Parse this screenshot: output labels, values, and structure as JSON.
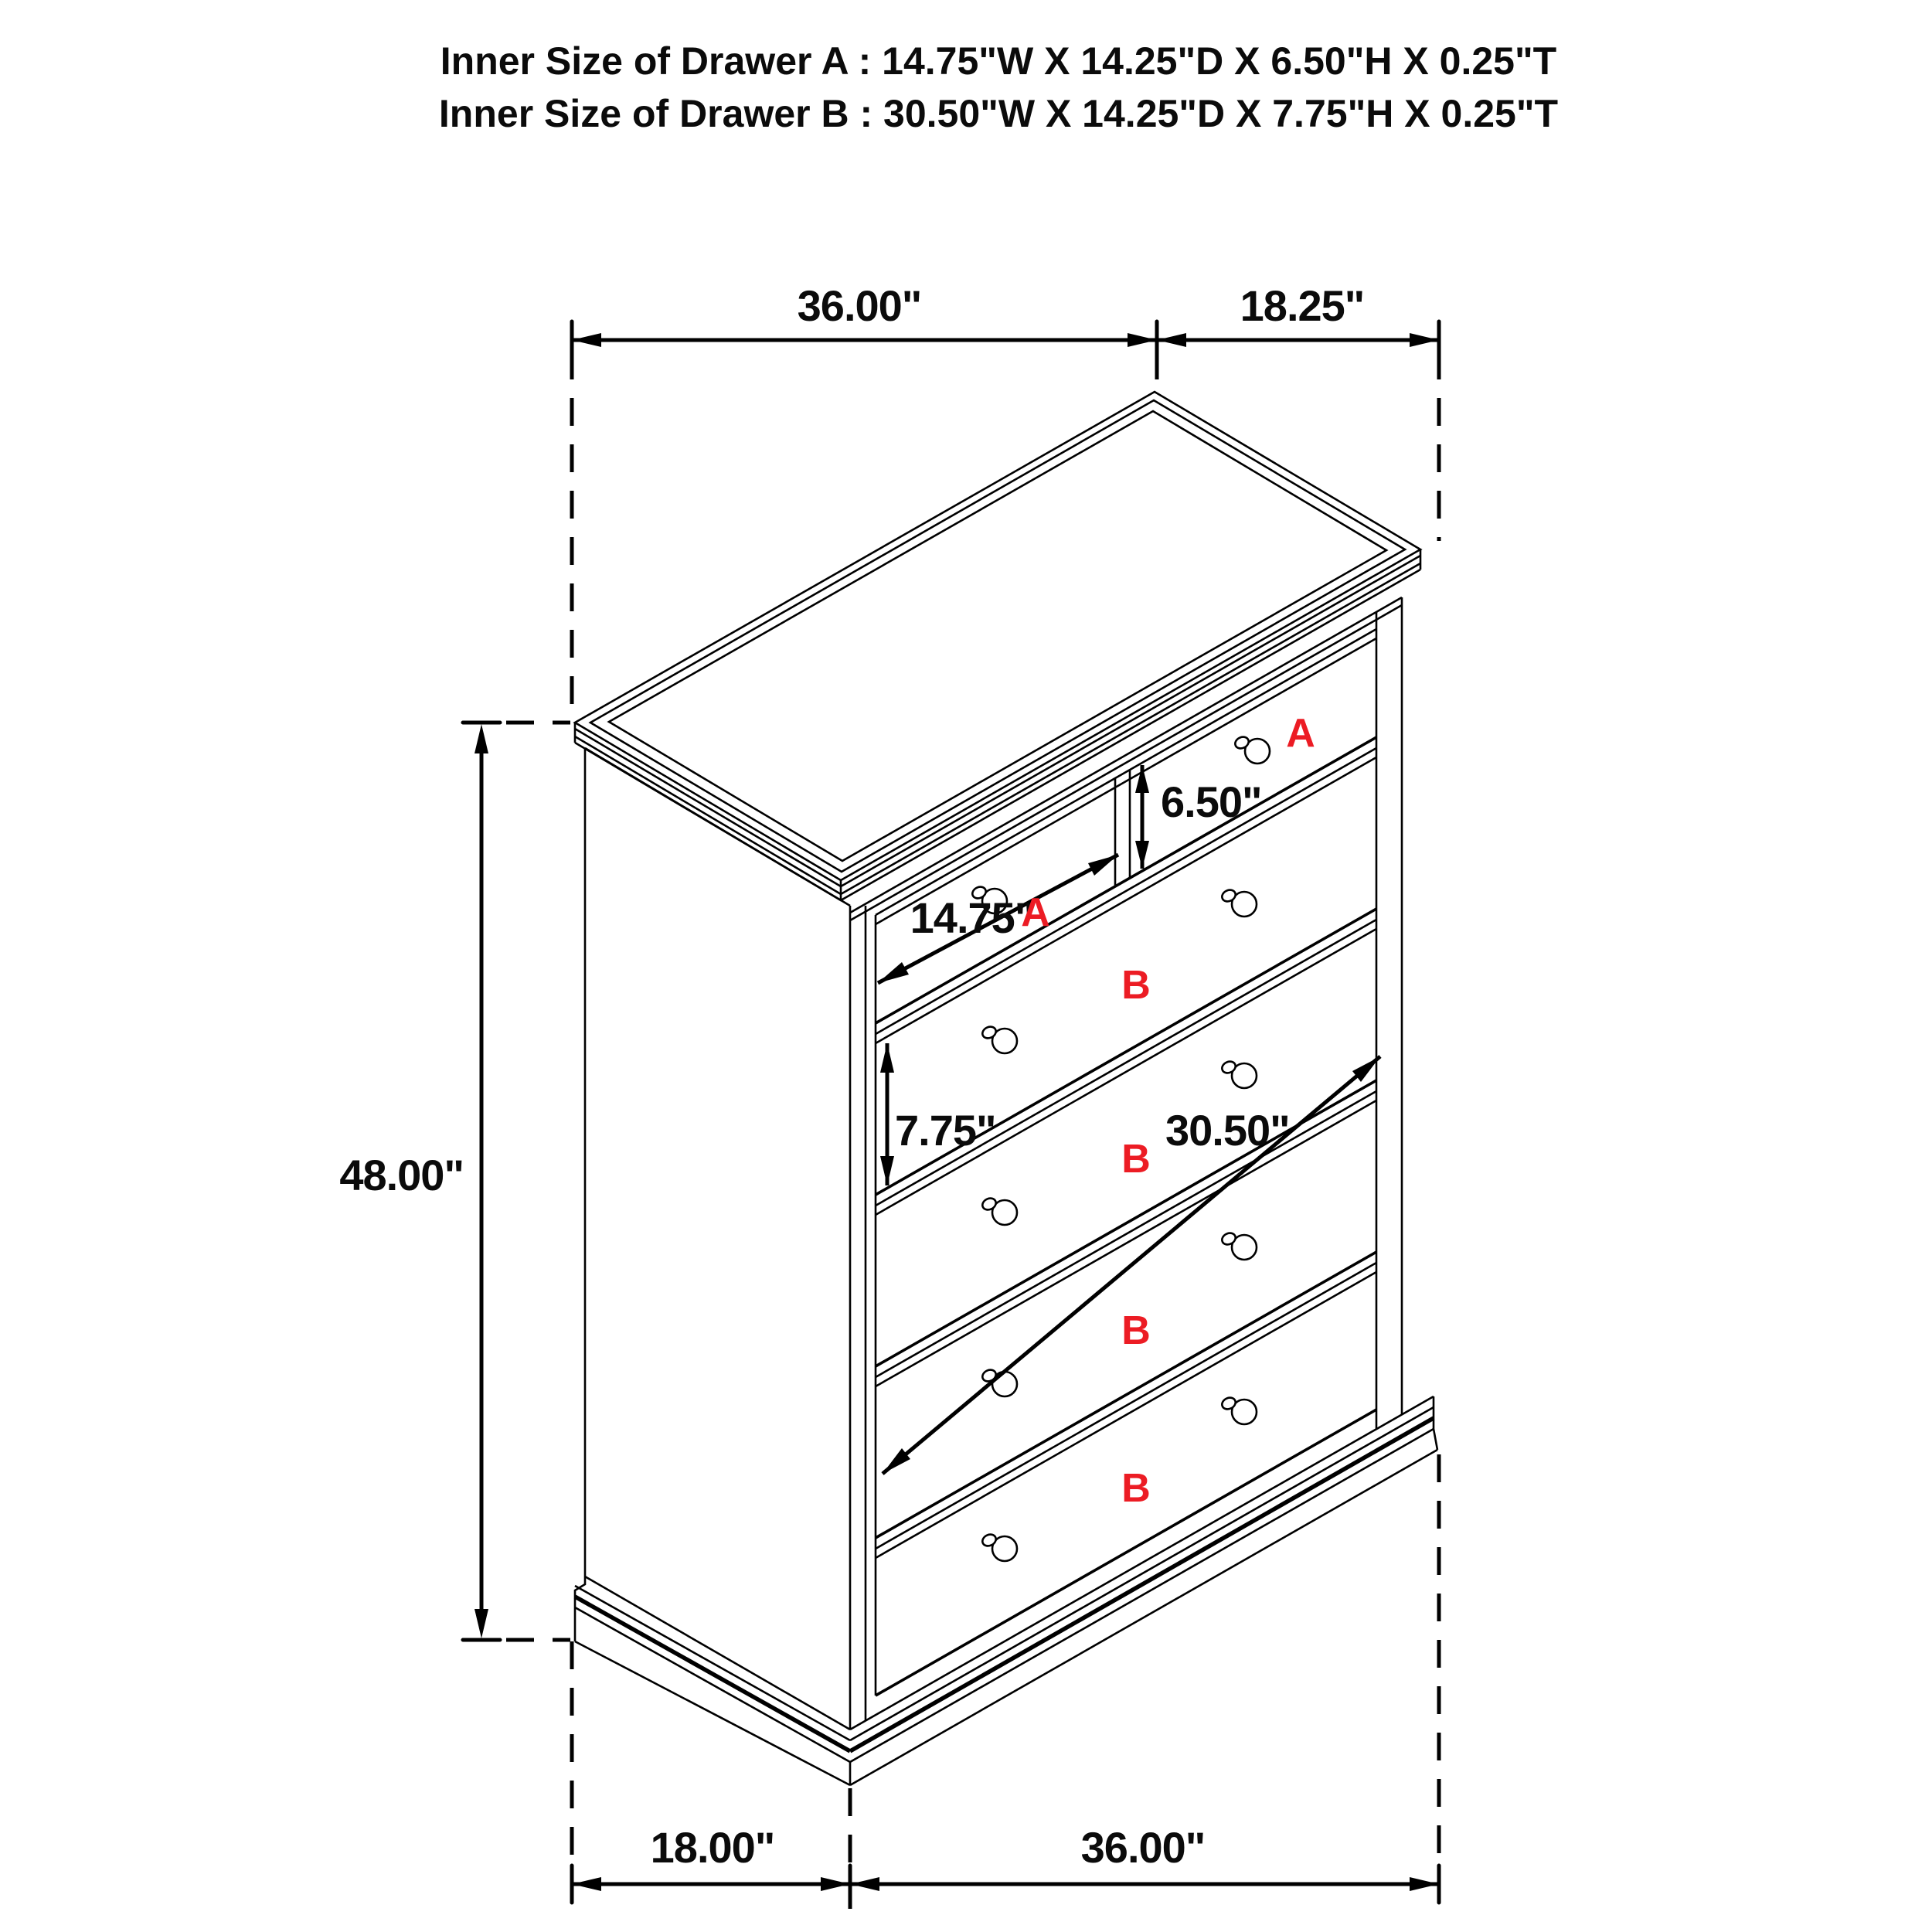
{
  "title": {
    "line1": "Inner Size of Drawer A : 14.75\"W X 14.25\"D X 6.50\"H X 0.25\"T",
    "line2": "Inner Size of Drawer B : 30.50\"W X 14.25\"D X 7.75\"H X 0.25\"T"
  },
  "drawing": {
    "dimensions": {
      "top_width": "36.00\"",
      "top_depth": "18.25\"",
      "overall_height": "48.00\"",
      "drawer_a_inner_height": "6.50\"",
      "drawer_a_inner_width": "14.75\"",
      "drawer_b_inner_height": "7.75\"",
      "drawer_b_inner_width": "30.50\"",
      "base_depth": "18.00\"",
      "base_width": "36.00\""
    },
    "drawer_labels": {
      "a": "A",
      "b": "B"
    },
    "colors": {
      "line": "#000000",
      "label_red": "#ec1c24",
      "background": "#ffffff"
    }
  }
}
